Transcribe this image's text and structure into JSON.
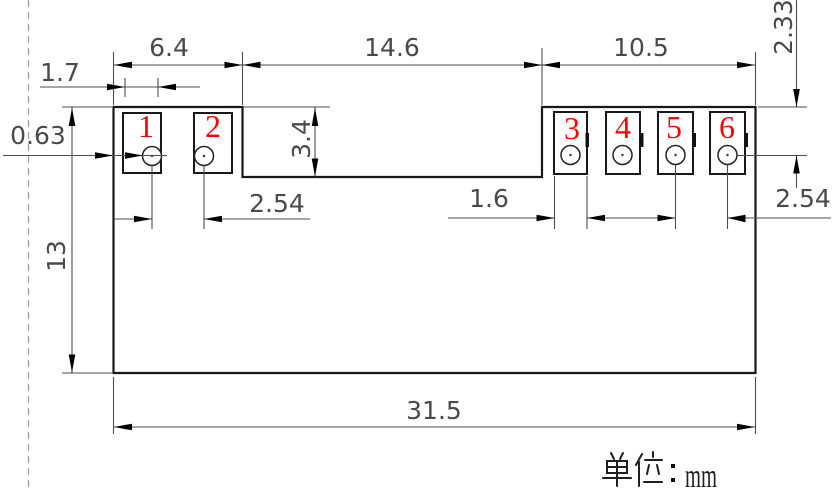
{
  "drawing": {
    "type": "mechanical-dimension-drawing",
    "units_label": "单位：mm",
    "units_value": "mm",
    "dimensions": {
      "span_left": "6.4",
      "span_middle": "14.6",
      "span_right": "10.5",
      "pad_left_width": "1.7",
      "hole_edge_offset": "0.63",
      "notch_height": "3.4",
      "left_pitch": "2.54",
      "pad_right_width": "1.6",
      "right_pitch": "2.54",
      "hole_center_from_top": "2.33",
      "body_height": "13",
      "body_width": "31.5"
    },
    "pads": [
      {
        "label": "1"
      },
      {
        "label": "2"
      },
      {
        "label": "3"
      },
      {
        "label": "4"
      },
      {
        "label": "5"
      },
      {
        "label": "6"
      }
    ],
    "colors": {
      "outline": "#181818",
      "dimension_lines": "#4d4d4d",
      "dimension_text": "#4a4a4a",
      "pad_number": "#fe0000",
      "dashed_line": "#9e9e9e",
      "background": "#ffffff"
    }
  }
}
